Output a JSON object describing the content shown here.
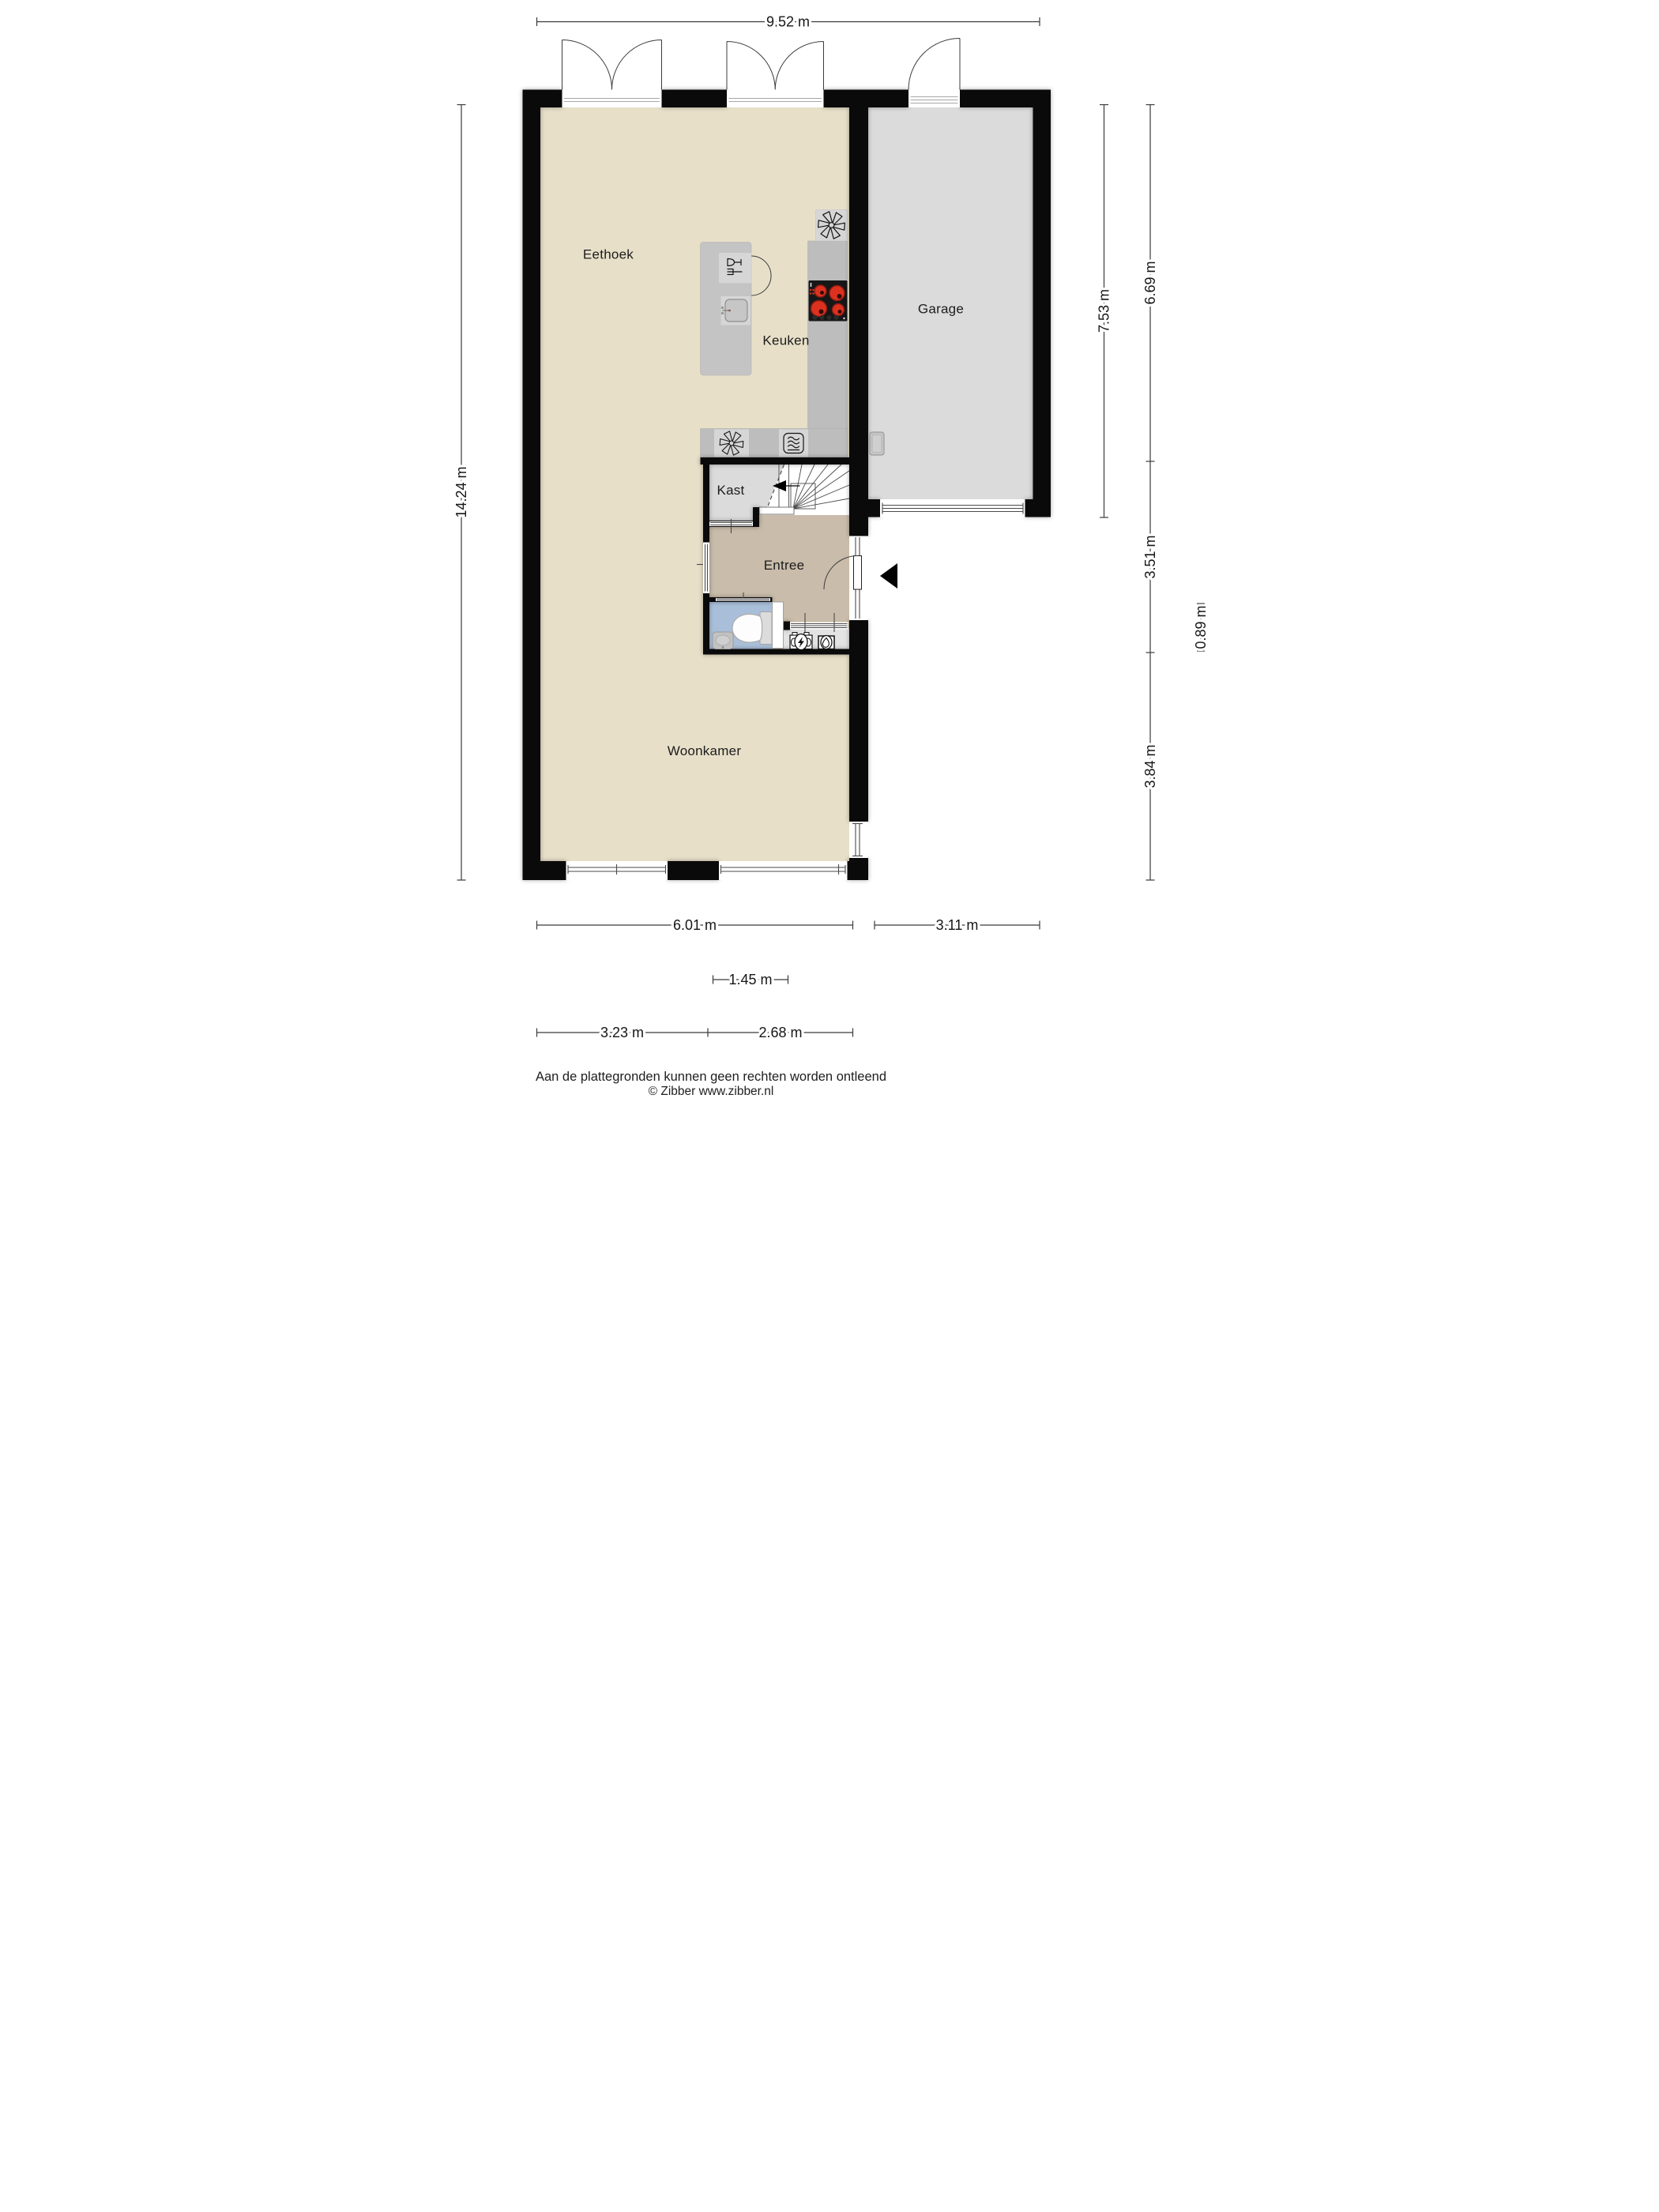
{
  "plan": {
    "rooms": {
      "eethoek": "Eethoek",
      "keuken": "Keuken",
      "garage": "Garage",
      "kast": "Kast",
      "entree": "Entree",
      "woonkamer": "Woonkamer"
    },
    "dimensions": {
      "top": "9.52 m",
      "left": "14.24 m",
      "right_inner": "7.53 m",
      "right_top": "6.69 m",
      "right_middle": "3.51 m",
      "right_small": "0.89 m",
      "right_bottom": "3.84 m",
      "bottom_house": "6.01 m",
      "bottom_garage": "3.11 m",
      "bottom_center": "1.45 m",
      "bottom_sub_left": "3.23 m",
      "bottom_sub_right": "2.68 m"
    },
    "footer": {
      "disclaimer": "Aan de plattegronden kunnen geen rechten worden ontleend",
      "credit": "© Zibber www.zibber.nl"
    },
    "icons": {
      "extractor_fan": "fan-asterisk",
      "oven": "oven-waves",
      "dishwasher": "glass-and-fork",
      "cooktop": "four-burner-hob",
      "electric_meter": "circle-lightning",
      "water_meter": "oval-waterdrop",
      "toilet": "wc-bowl",
      "stair_direction": "left-arrow",
      "entrance": "left-arrow"
    },
    "colors": {
      "wall": "#0a0a0a",
      "floor_main": "#e7dfc8",
      "floor_garage": "#dbdbdb",
      "floor_kast": "#dbdbdb",
      "floor_entree": "#c9bcaa",
      "floor_toilet": "#a9bfd9",
      "floor_meterkast": "#e3e3e3",
      "counter": "#bdbdbd",
      "counter_light": "#d6d6d6",
      "island": "#c4c4c4",
      "hob": "#171717",
      "burner": "#dd3120",
      "dim_line": "#3a3a3a",
      "label_text": "#1c1c1c"
    }
  }
}
